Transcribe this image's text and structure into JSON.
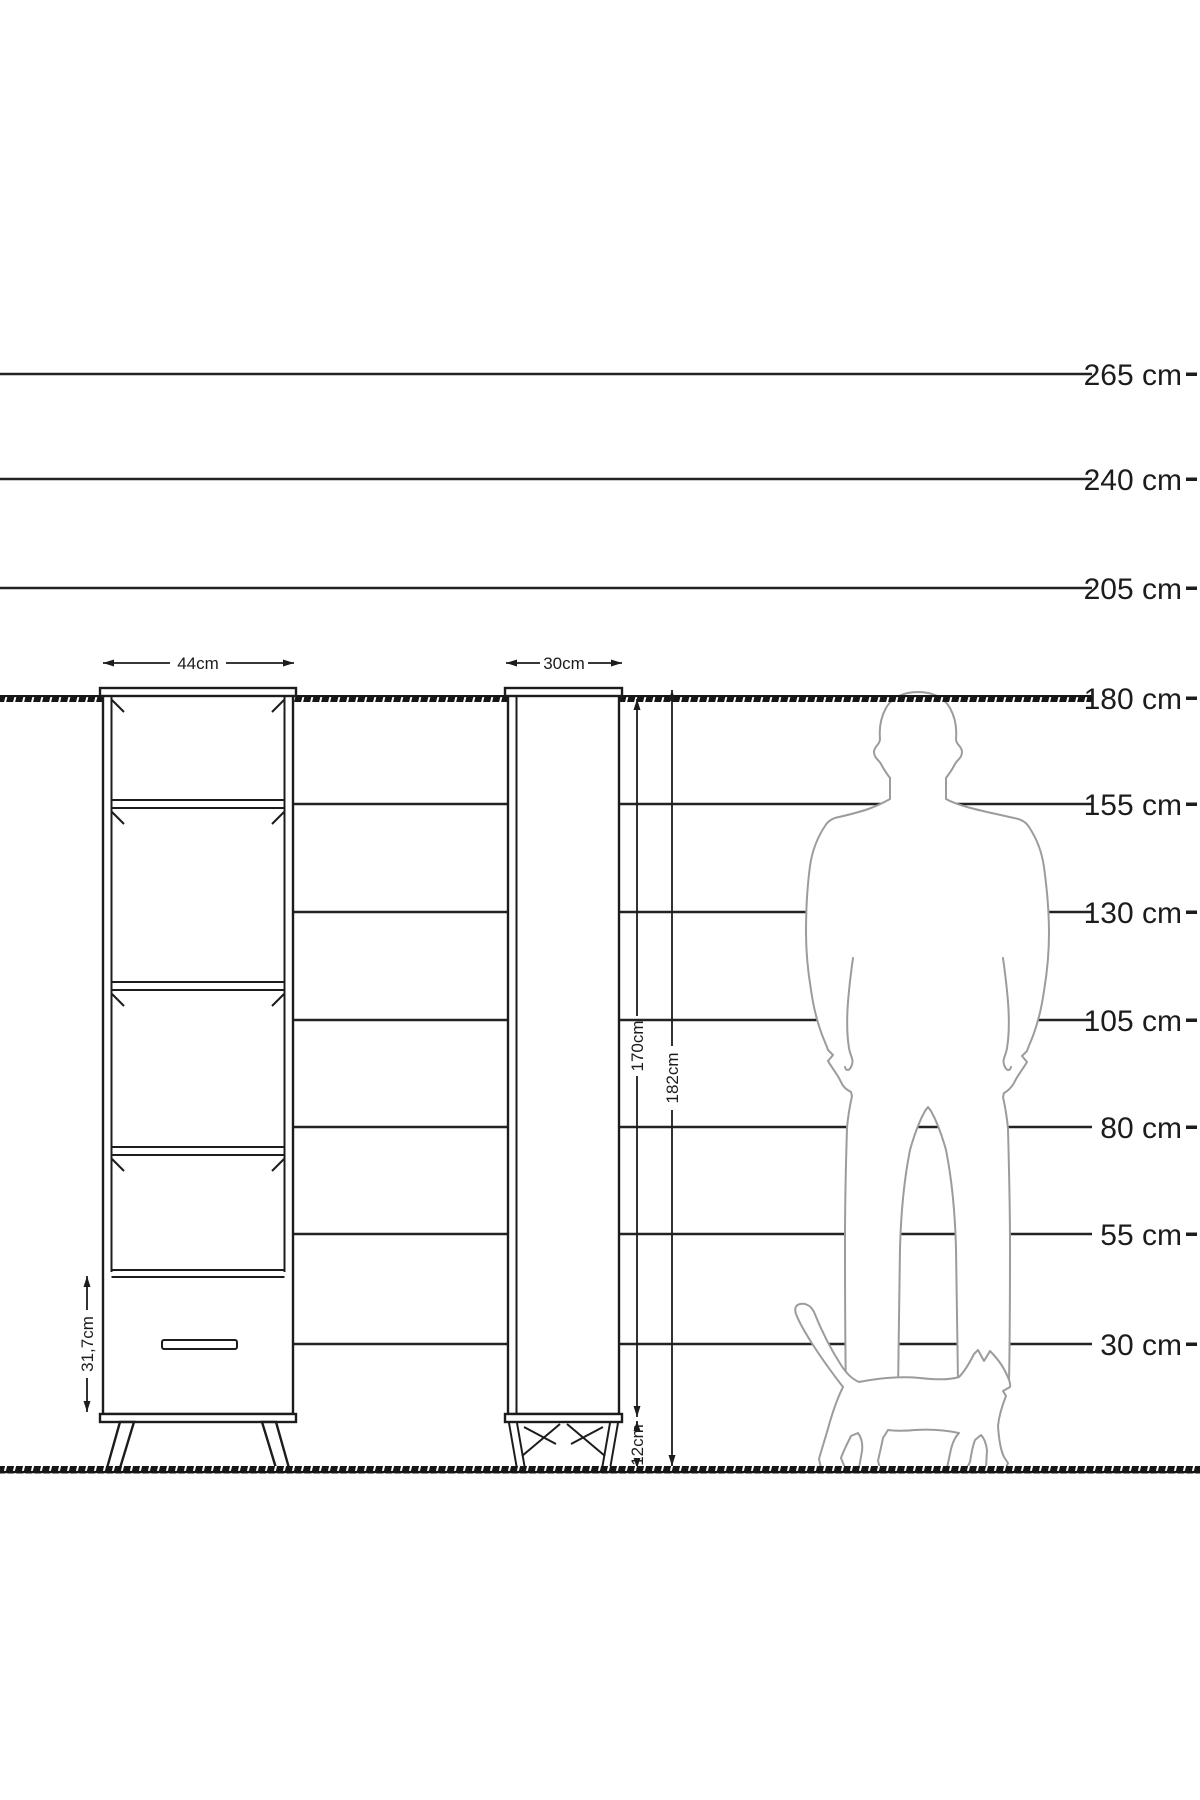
{
  "scale": {
    "unit": "cm",
    "tick_labels": [
      "265 cm",
      "240 cm",
      "205 cm",
      "180 cm",
      "155 cm",
      "130 cm",
      "105 cm",
      "80 cm",
      "55 cm",
      "30 cm"
    ],
    "tick_values_cm": [
      265,
      240,
      205,
      180,
      155,
      130,
      105,
      80,
      55,
      30
    ]
  },
  "front_view": {
    "width_label": "44cm",
    "width_cm": 44,
    "drawer_height_label": "31,7cm",
    "drawer_height_cm": 31.7,
    "shelf_compartments": 4,
    "drawers": 1
  },
  "side_view": {
    "depth_label": "30cm",
    "depth_cm": 30,
    "body_height_label": "170cm",
    "body_height_cm": 170,
    "total_height_label": "182cm",
    "total_height_cm": 182,
    "leg_height_label": "12cm",
    "leg_height_cm": 12
  },
  "icons": {
    "man": "man-silhouette",
    "cat": "cat-silhouette"
  },
  "colors": {
    "line": "#1c1c1c",
    "silhouette_stroke": "#9c9c9c",
    "background": "#ffffff"
  }
}
